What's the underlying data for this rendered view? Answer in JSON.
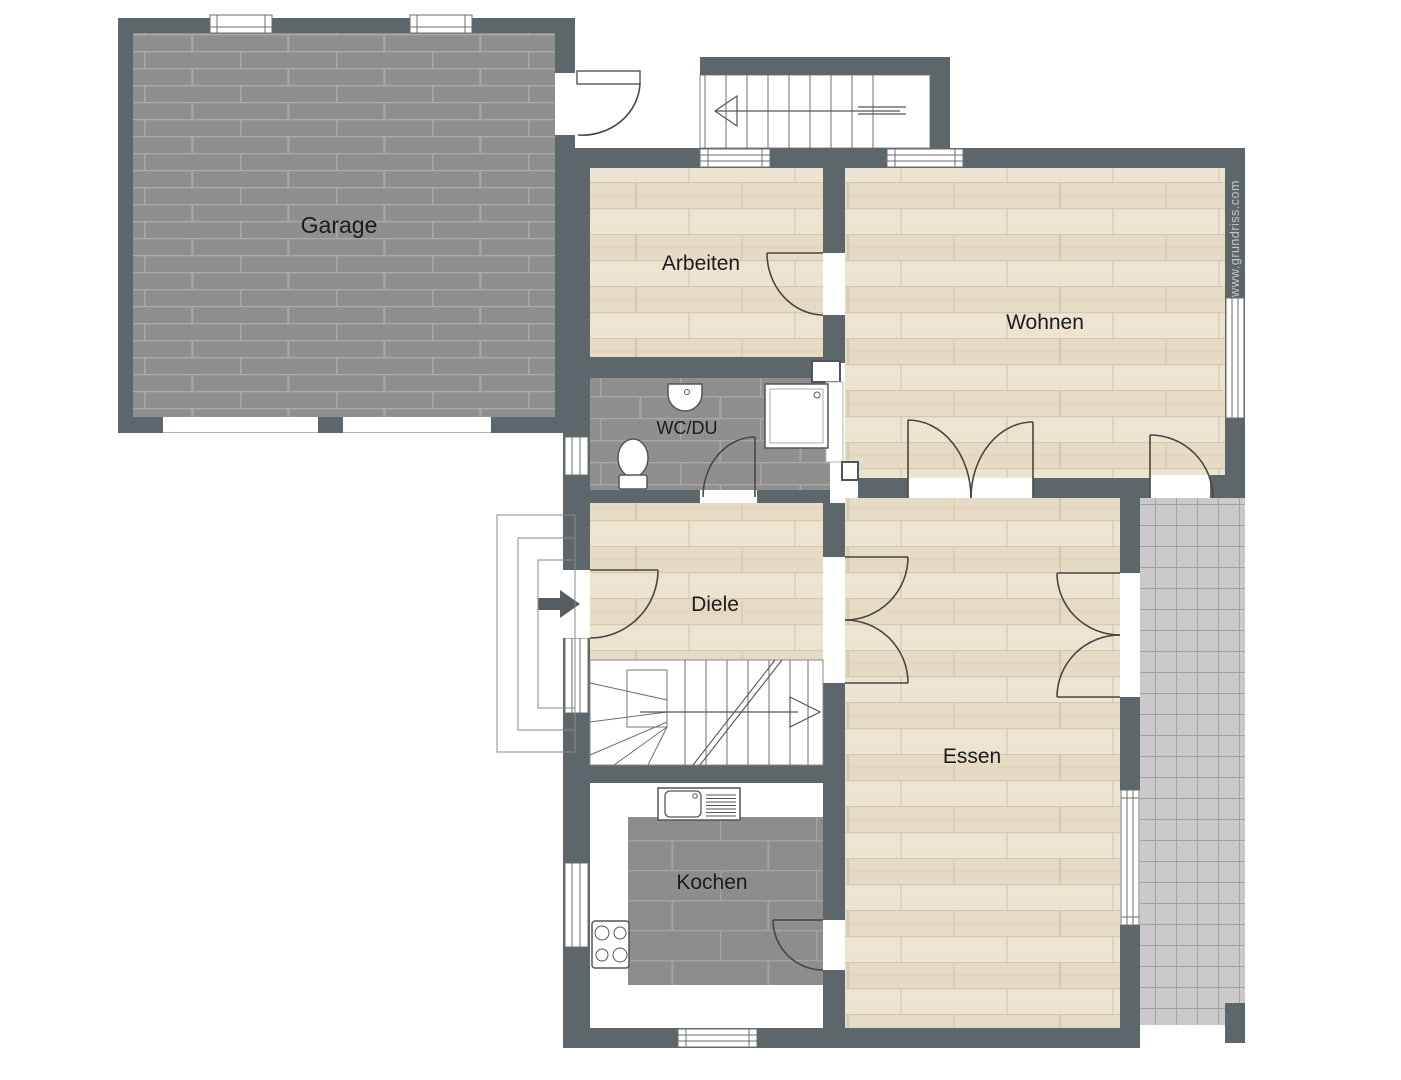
{
  "plan": {
    "title": "Erdgeschoss Grundriss",
    "watermark": "www.grundriss.com",
    "rooms": [
      {
        "id": "garage",
        "label": "Garage"
      },
      {
        "id": "arbeiten",
        "label": "Arbeiten"
      },
      {
        "id": "wohnen",
        "label": "Wohnen"
      },
      {
        "id": "wc-du",
        "label": "WC/DU"
      },
      {
        "id": "diele",
        "label": "Diele"
      },
      {
        "id": "essen",
        "label": "Essen"
      },
      {
        "id": "kochen",
        "label": "Kochen"
      }
    ],
    "colors": {
      "wall": "#5c666b",
      "wood_floor": "#e9e0cb",
      "tile_floor": "#8f8f8f",
      "terrace": "#cbcaca",
      "background": "#ffffff",
      "watermark_text": "#c2c6c8"
    }
  }
}
